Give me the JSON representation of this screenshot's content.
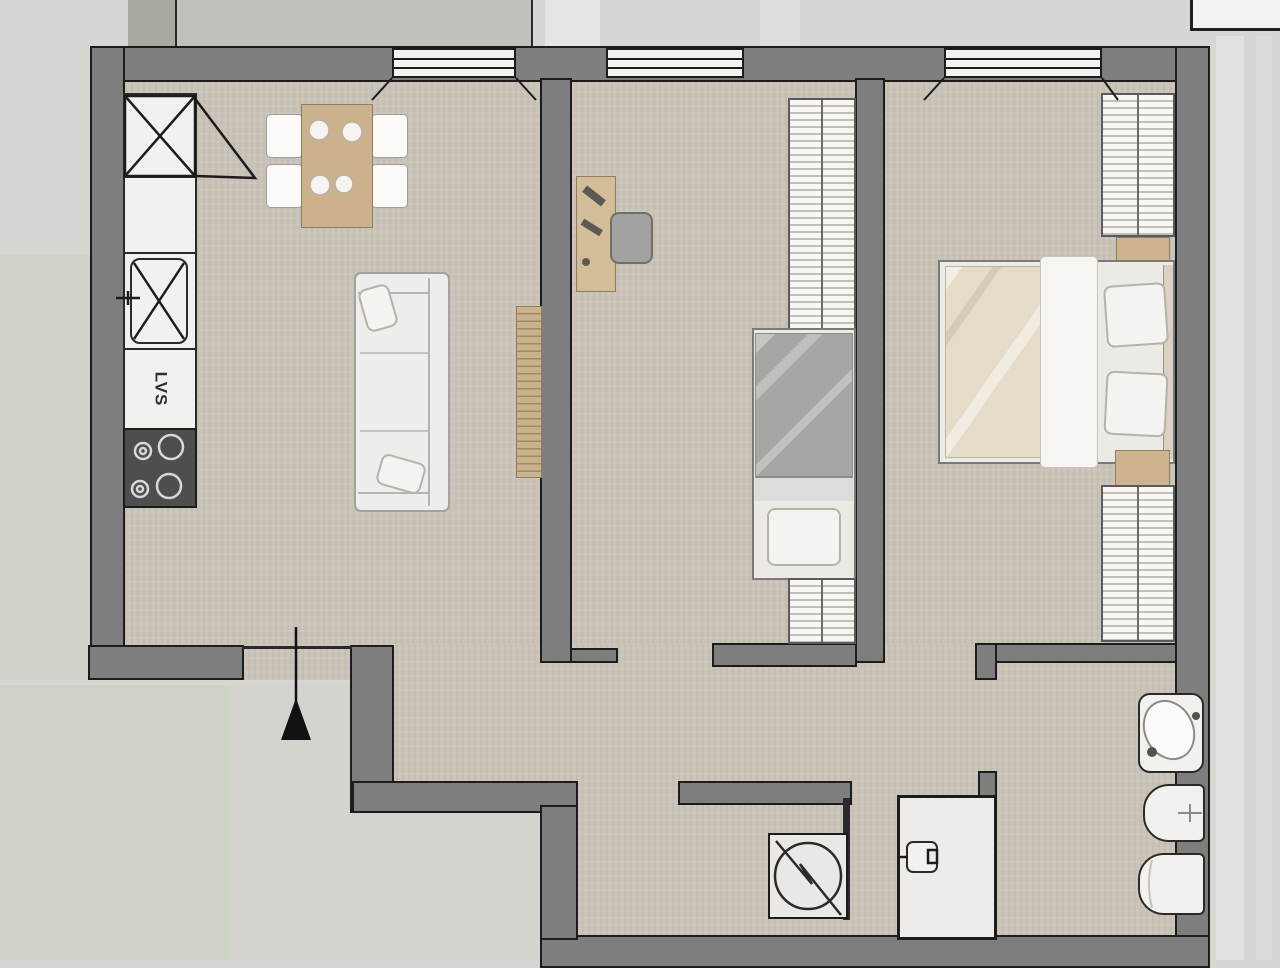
{
  "plan": {
    "type": "apartment-floor-plan",
    "labels": {
      "dishwasher": "LVS"
    },
    "colors": {
      "wall_fill": "#7e7e7e",
      "wall_outline": "#1c1c1c",
      "floor": "#c9c3b8",
      "exterior": "#d7d6d3",
      "greenery_tint": "#ccd1c4",
      "fixture_white": "#f2f1ee",
      "wood": "#ccb28c",
      "stove_dark": "#4e4e4e",
      "duvet_gray": "#a6a6a4",
      "duvet_beige": "#e4dcc8"
    },
    "rooms": [
      {
        "name": "living-room-with-kitchen",
        "furniture": [
          "corner-unit",
          "kitchen-sink",
          "dishwasher",
          "stove",
          "dining-table",
          "four-chairs",
          "sofa",
          "radiator"
        ]
      },
      {
        "name": "bedroom-middle",
        "furniture": [
          "desk",
          "desk-chair",
          "wardrobe",
          "single-bed"
        ]
      },
      {
        "name": "bedroom-right",
        "furniture": [
          "wardrobe-top",
          "nightstand-top",
          "double-bed",
          "nightstand-bottom",
          "wardrobe-bottom"
        ]
      },
      {
        "name": "hallway",
        "furniture": [
          "entrance-arrow"
        ]
      },
      {
        "name": "laundry-niche",
        "furniture": [
          "washing-machine"
        ]
      },
      {
        "name": "bathroom",
        "furniture": [
          "shower",
          "washbasin",
          "bidet",
          "toilet"
        ]
      }
    ],
    "icons": [
      "corner-unit-x-icon",
      "sink-x-icon",
      "faucet-icon",
      "burner-icon",
      "plate-icon",
      "entrance-arrow-icon",
      "washing-machine-icon",
      "shower-mixer-icon",
      "bidet-cross-icon"
    ],
    "windows_count": 3
  }
}
